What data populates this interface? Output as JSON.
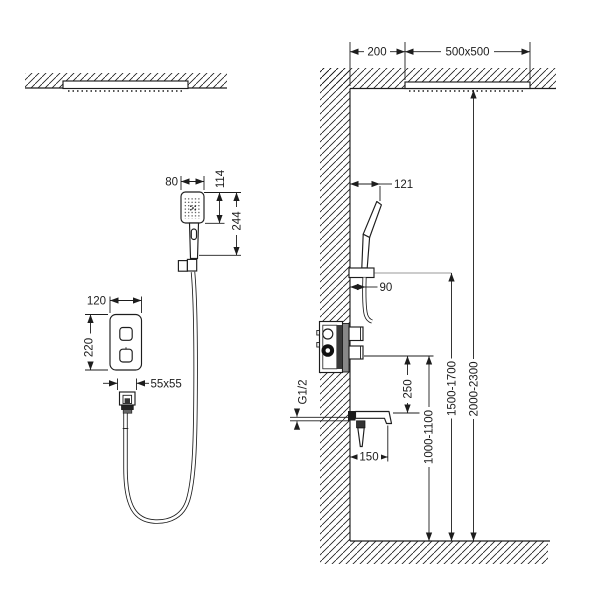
{
  "drawing": {
    "kind": "shower-system-installation-diagram",
    "colors": {
      "line": "#1d1d1d",
      "gray_line": "#9a9a9a",
      "background": "#ffffff"
    },
    "front_view": {
      "dimensions": {
        "hand_shower_width": "80",
        "hand_shower_head_height": "114",
        "hand_shower_length": "244",
        "panel_width": "120",
        "panel_height": "220",
        "outlet_flange": "55x55"
      }
    },
    "side_view": {
      "dimensions": {
        "wall_offset": "200",
        "ceiling_head_size": "500x500",
        "hand_shower_tip_offset": "121",
        "hose_offset": "90",
        "pipe_thread": "G1/2",
        "valve_to_spout": "250",
        "spout_reach": "150",
        "spout_height": "1000-1100",
        "bracket_height": "1500-1700",
        "ceiling_head_height": "2000-2300"
      }
    }
  }
}
